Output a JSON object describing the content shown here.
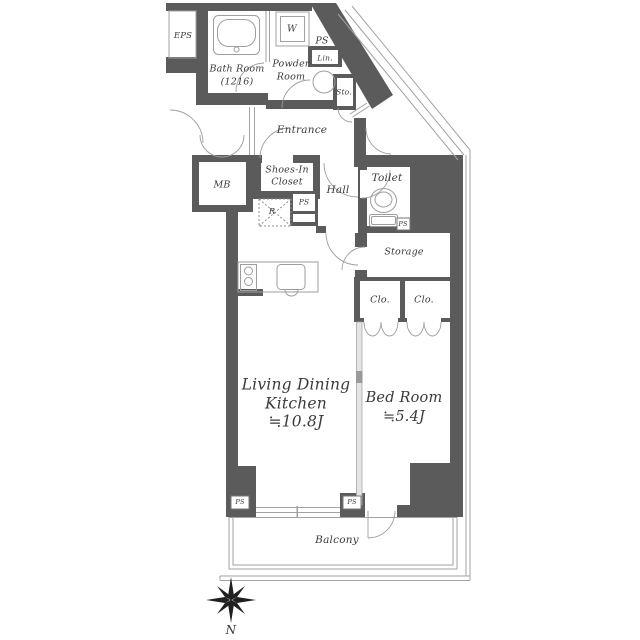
{
  "title": "Apartment floor plan 1LDK",
  "colors": {
    "wall": "#5b5b5b",
    "thin_line": "#a2a2a2",
    "fixture_line": "#9e9e9e",
    "text": "#3a3a3a",
    "partition_fill": "#e4e4e4",
    "compass": "#1f1f1f"
  },
  "labels": {
    "eps": "EPS",
    "bath_room_1": "Bath Room",
    "bath_room_2": "(1216)",
    "w": "W",
    "ps": "PS",
    "lin": "Lin.",
    "sto": "Sto.",
    "powder_1": "Powder",
    "powder_2": "Room",
    "entrance": "Entrance",
    "mb": "MB",
    "shoes_in_1": "Shoes-In",
    "shoes_in_2": "Closet",
    "r": "R",
    "hall": "Hall",
    "toilet": "Toilet",
    "storage": "Storage",
    "clo": "Clo.",
    "ldk_1": "Living Dining",
    "ldk_2": "Kitchen",
    "ldk_area": "≒10.8J",
    "bed_1": "Bed Room",
    "bed_area": "≒5.4J",
    "balcony": "Balcony",
    "north": "N"
  },
  "icons": {
    "bathtub": "bathtub-icon",
    "washing_machine": "washer-circle-icon",
    "toilet": "toilet-icon",
    "stove": "stove-icon",
    "sink": "sink-icon",
    "refrigerator_space": "refrigerator-dashed-icon",
    "compass": "compass-rose-icon"
  }
}
